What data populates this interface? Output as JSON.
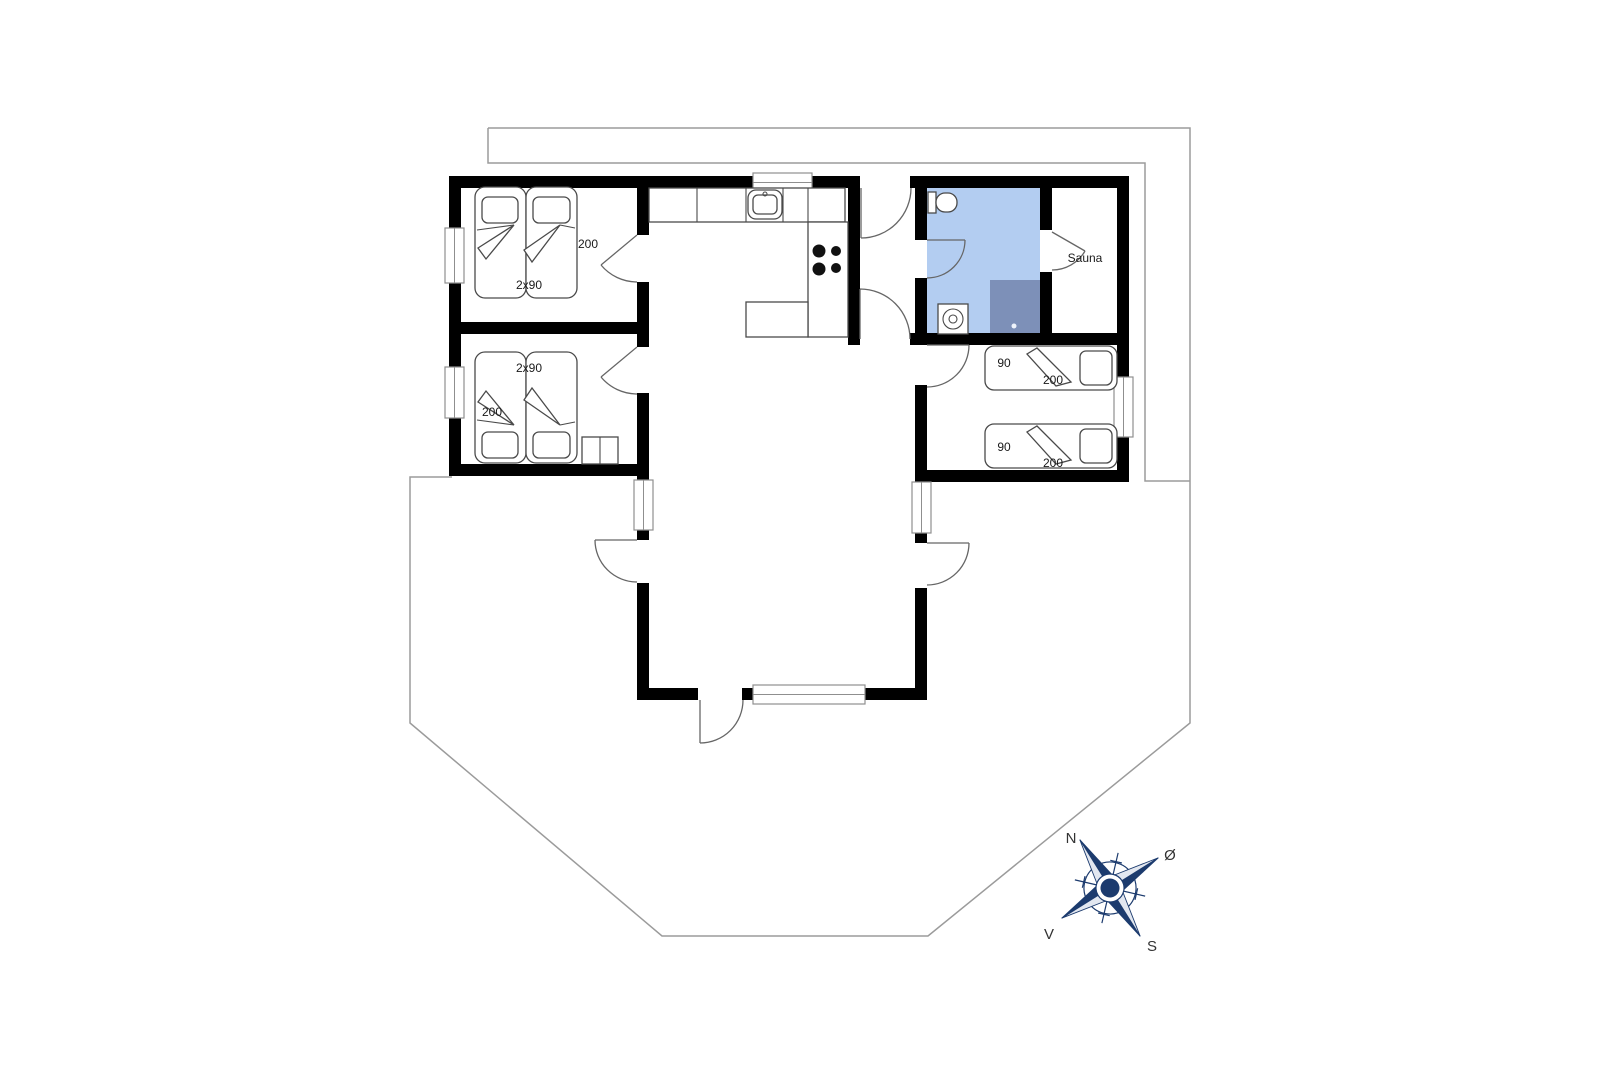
{
  "plan": {
    "type": "holiday-house-floor-plan",
    "bedroom_left_top": {
      "bed_length": "200",
      "bed_width": "2x90"
    },
    "bedroom_left_bottom": {
      "bed_width": "2x90",
      "bed_length": "200"
    },
    "bedroom_right": {
      "bed1_width": "90",
      "bed1_length": "200",
      "bed2_width": "90",
      "bed2_length": "200"
    },
    "sauna": {
      "label": "Sauna"
    }
  },
  "compass": {
    "north": "N",
    "east": "Ø",
    "south": "S",
    "west": "V"
  },
  "colors": {
    "wall": "#000000",
    "bathroom_fill": "#b3cdf1",
    "shower_fill": "#7d90b8",
    "compass_navy": "#1c3b6e",
    "site_outline": "#9b9b9b",
    "furniture_stroke": "#4a4a4a",
    "door_stroke": "#666666",
    "label_color": "#1a1a1a"
  }
}
